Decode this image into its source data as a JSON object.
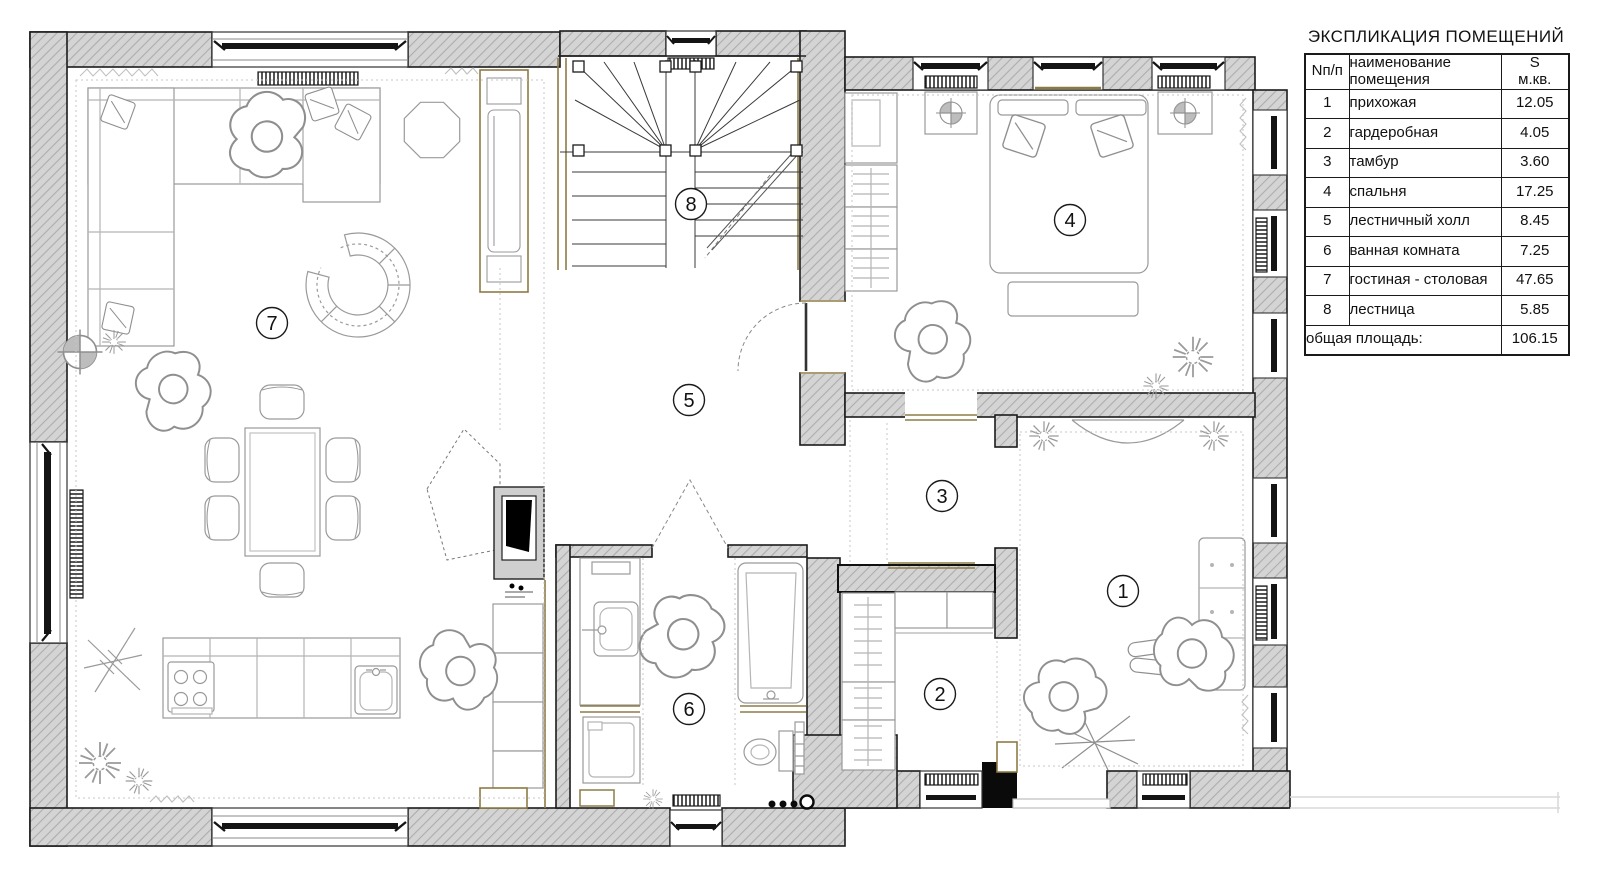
{
  "legend": {
    "title": "ЭКСПЛИКАЦИЯ ПОМЕЩЕНИЙ",
    "headers": {
      "num": "Nп/п",
      "name": "наименование\nпомещения",
      "area": "S\nм.кв."
    },
    "rows": [
      {
        "num": "1",
        "name": "прихожая",
        "area": "12.05"
      },
      {
        "num": "2",
        "name": "гардеробная",
        "area": "4.05"
      },
      {
        "num": "3",
        "name": "тамбур",
        "area": "3.60"
      },
      {
        "num": "4",
        "name": "спальня",
        "area": "17.25"
      },
      {
        "num": "5",
        "name": "лестничный холл",
        "area": "8.45"
      },
      {
        "num": "6",
        "name": "ванная комната",
        "area": "7.25"
      },
      {
        "num": "7",
        "name": "гостиная - столовая",
        "area": "47.65"
      },
      {
        "num": "8",
        "name": "лестница",
        "area": "5.85"
      }
    ],
    "total": {
      "label": "общая площадь:",
      "area": "106.15"
    }
  },
  "plan": {
    "room_labels": [
      "1",
      "2",
      "3",
      "4",
      "5",
      "6",
      "7",
      "8"
    ]
  },
  "colors": {
    "wall_fill": "#d4d4d4",
    "hatch_line": "#adadad",
    "outline": "#1b1b1b",
    "accent_olive": "#8d7b45",
    "furniture_line": "#9a9a9a"
  }
}
